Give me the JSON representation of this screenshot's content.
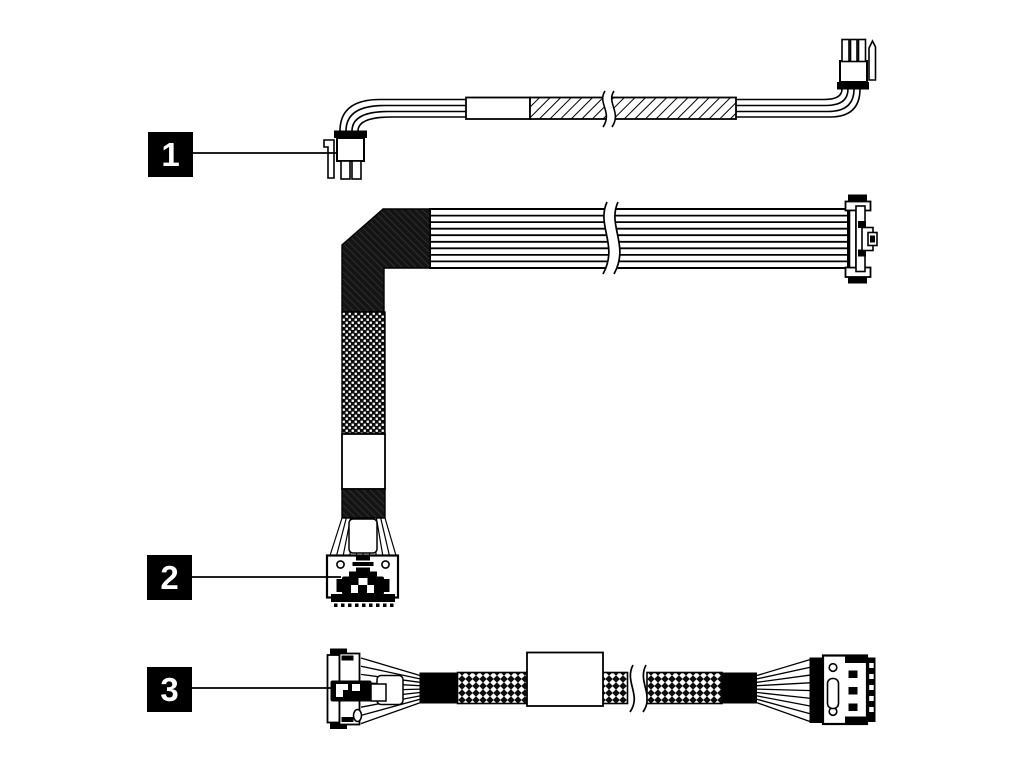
{
  "colors": {
    "background": "#ffffff",
    "line": "#000000",
    "callout_bg": "#000000",
    "callout_text": "#ffffff"
  },
  "callouts": [
    {
      "label": "1",
      "target": "power-cable"
    },
    {
      "label": "2",
      "target": "flat-ribbon-cable"
    },
    {
      "label": "3",
      "target": "braided-cable"
    }
  ],
  "figures": [
    {
      "name": "power-cable",
      "parts": [
        "4-pin-power-connector",
        "wire-bundle",
        "sleeve-label",
        "hatched-sleeve",
        "break-symbol",
        "3-pin-power-connector"
      ]
    },
    {
      "name": "flat-ribbon-cable",
      "parts": [
        "dense-hatch-sleeve",
        "woven-sleeve",
        "blank-label",
        "break-symbol",
        "mcio-connector",
        "edge-connector"
      ]
    },
    {
      "name": "braided-cable",
      "parts": [
        "mcio-connector",
        "wire-fanout",
        "braided-sleeve",
        "blank-label",
        "break-symbol",
        "slimline-connector"
      ]
    }
  ]
}
